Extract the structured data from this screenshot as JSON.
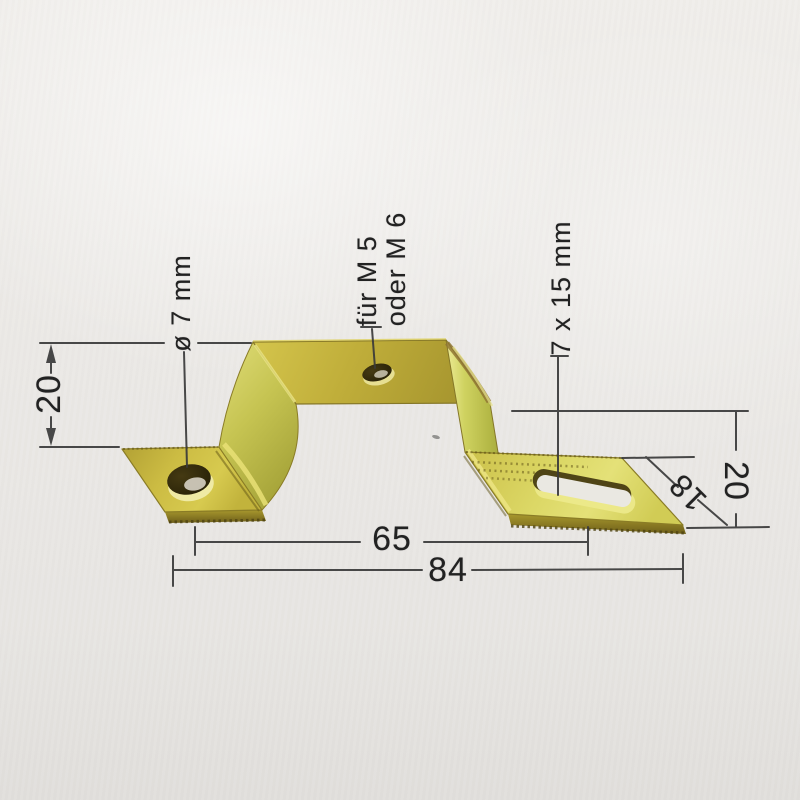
{
  "annotations": {
    "left_hole": "ø 7 mm",
    "center_hole_line1": "für M 5",
    "center_hole_line2": "oder M 6",
    "right_slot": "7 x 15 mm"
  },
  "dimensions": {
    "left_height": "20",
    "right_height": "20",
    "flange_depth": "18",
    "inner_span": "65",
    "overall_span": "84"
  },
  "colors": {
    "background": "#eae8e5",
    "dimension_line": "#3a3a3a",
    "text": "#222222",
    "brass_light": "#dcd86a",
    "brass_mid": "#c4b63e",
    "brass_dark": "#8a7a24",
    "edge_shadow": "#6e5f1a",
    "hole_dark": "#2a2308"
  }
}
